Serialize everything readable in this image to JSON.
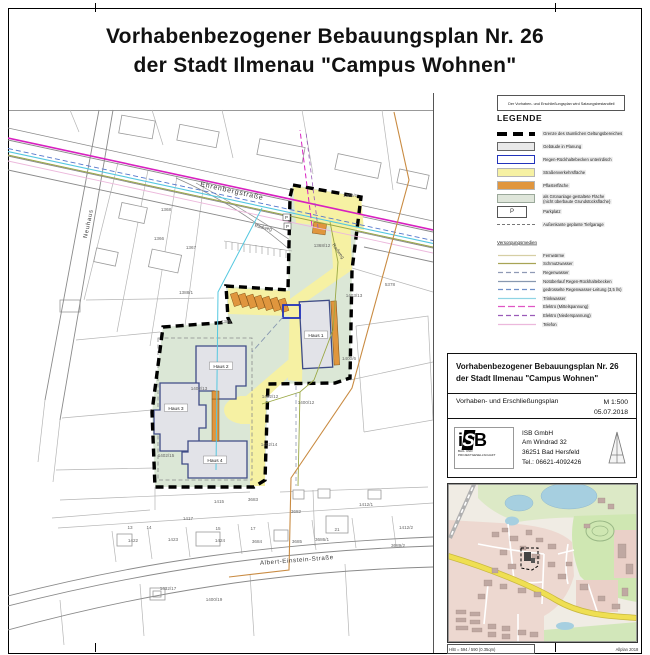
{
  "page": {
    "title_line1": "Vorhabenbezogener Bebauungsplan Nr. 26",
    "title_line2": "der Stadt Ilmenau \"Campus Wohnen\""
  },
  "legend": {
    "note": "Der Vorhaben- und Erschließungsplan wird Satzungsbestandteil",
    "heading": "LEGENDE",
    "parking_letter": "P",
    "areas": [
      {
        "type": "boundary",
        "label": "Grenze des räumlichen Geltungsbereiches"
      },
      {
        "type": "fill",
        "fill": "#e9e9e9",
        "stroke": "#666666",
        "label": "Gebäude in Planung"
      },
      {
        "type": "fill",
        "fill": "#ffffff",
        "stroke": "#2233bb",
        "bw": 1.6,
        "label": "Regen-Rückhaltebecken unterirdisch"
      },
      {
        "type": "fill",
        "fill": "#f6f1a3",
        "stroke": "#b5b5b5",
        "label": "Straßenverkehrsfläche"
      },
      {
        "type": "fill",
        "fill": "#e0963e",
        "stroke": "#b5b5b5",
        "label": "Pflasterfläche"
      },
      {
        "type": "fill",
        "fill": "#dfe6da",
        "stroke": "#9aa89a",
        "label": "als Grünanlage gestaltete Fläche",
        "label2": "(nicht überbaute Grundstücksfläche)"
      },
      {
        "type": "p",
        "label": "Parkplatz"
      },
      {
        "type": "dash",
        "label": "Außenkante geplante Tiefgarage"
      }
    ],
    "utilities_heading": "Versorgungsmedien",
    "utilities": [
      {
        "label": "Fernwärme",
        "color": "#d6cfa4",
        "dash": ""
      },
      {
        "label": "Schmutzwasser",
        "color": "#a8a455",
        "dash": ""
      },
      {
        "label": "Regenwasser",
        "color": "#8f9ab5",
        "dash": "5,3"
      },
      {
        "label": "Notüberlauf Regen-Rückhaltebecken",
        "color": "#8898b0",
        "dash": ""
      },
      {
        "label": "gedrosselte Regenwasser-Leitung (3,5 l/s)",
        "color": "#7090c8",
        "dash": "5,3"
      },
      {
        "label": "Trinkwasser",
        "color": "#8fd4e4",
        "dash": ""
      },
      {
        "label": "Elektro (Mittelspannung)",
        "color": "#e055c5",
        "dash": "7,3"
      },
      {
        "label": "Elektro (Niederspannung)",
        "color": "#9a5ab8",
        "dash": "5,3"
      },
      {
        "label": "Telefon",
        "color": "#ecb8dc",
        "dash": ""
      }
    ]
  },
  "titleblock": {
    "title_line1": "Vorhabenbezogener Bebauungsplan Nr. 26",
    "title_line2": "der Stadt Ilmenau \"Campus Wohnen\"",
    "subtitle": "Vorhaben- und Erschließungsplan",
    "scale": "M 1:500",
    "date": "05.07.2018",
    "company": {
      "name": "ISB GmbH",
      "street": "Am Windrad 32",
      "city": "36251  Bad Hersfeld",
      "phone": "Tel.: 06621-4092426"
    },
    "logo": {
      "i": "i",
      "s": "S",
      "b": "B",
      "sub1": "BAU- UND",
      "sub2": "PROJEKTGESELLSCHAFT"
    }
  },
  "minimap": {
    "caption_left": "H/B = 594 / 590 (0.35qm)",
    "caption_right": "Allplan 2018"
  },
  "map": {
    "colors": {
      "street_yellow": "#f6f1a3",
      "paving_orange": "#e0963e",
      "green_area": "#dbe7d6",
      "building_fill": "#e2e3e8",
      "building_stroke": "#3f4c86",
      "basin_stroke": "#2233bb",
      "boundary": "#000000",
      "elektro_ms": "#d820c0",
      "trinkwasser": "#55c8e0",
      "schmutzwasser": "#9aa845",
      "regenwasser": "#5577cc",
      "fernwaerme": "#c98b42"
    },
    "parking_letter": "P",
    "streets": [
      {
        "name": "Ehrenbergstraße",
        "x": 200,
        "y": 186,
        "rot": 12.5,
        "fs": 7,
        "ls": 0.8,
        "anchor": "start"
      },
      {
        "name": "Neuhaus",
        "x": 90,
        "y": 224,
        "rot": -78,
        "fs": 6,
        "ls": 0.8,
        "anchor": "middle"
      },
      {
        "name": "Albert-Einstein-Straße",
        "x": 297,
        "y": 562,
        "rot": -4.5,
        "fs": 6.2,
        "ls": 0.6,
        "anchor": "middle"
      }
    ],
    "path_labels": [
      {
        "t": "Radweg",
        "x": 263,
        "y": 229,
        "rot": 13
      },
      {
        "t": "Radweg",
        "x": 337,
        "y": 252,
        "rot": 55
      }
    ],
    "houses": [
      {
        "label": "Haus 1",
        "x": 316,
        "y": 336
      },
      {
        "label": "Haus 2",
        "x": 221,
        "y": 367
      },
      {
        "label": "Haus 3",
        "x": 176,
        "y": 409
      },
      {
        "label": "Haus 4",
        "x": 215,
        "y": 461
      }
    ],
    "parcel_labels": [
      {
        "t": "1368",
        "x": 166,
        "y": 211
      },
      {
        "t": "1366",
        "x": 159,
        "y": 240
      },
      {
        "t": "1367",
        "x": 191,
        "y": 249
      },
      {
        "t": "1388/1",
        "x": 186,
        "y": 294
      },
      {
        "t": "1386",
        "x": 226,
        "y": 323
      },
      {
        "t": "1368/6",
        "x": 350,
        "y": 197
      },
      {
        "t": "1368/12",
        "x": 322,
        "y": 247
      },
      {
        "t": "5378",
        "x": 390,
        "y": 286
      },
      {
        "t": "1403/13",
        "x": 354,
        "y": 297
      },
      {
        "t": "1400/6",
        "x": 349,
        "y": 360
      },
      {
        "t": "1400/12",
        "x": 306,
        "y": 404
      },
      {
        "t": "1402/12",
        "x": 270,
        "y": 398
      },
      {
        "t": "1402/13",
        "x": 199,
        "y": 390
      },
      {
        "t": "1402/14",
        "x": 269,
        "y": 446
      },
      {
        "t": "1402/15",
        "x": 166,
        "y": 457
      },
      {
        "t": "1415",
        "x": 219,
        "y": 503
      },
      {
        "t": "3683",
        "x": 253,
        "y": 501
      },
      {
        "t": "3682",
        "x": 296,
        "y": 513
      },
      {
        "t": "1412/1",
        "x": 366,
        "y": 506
      },
      {
        "t": "1412/2",
        "x": 406,
        "y": 529
      },
      {
        "t": "3689/2",
        "x": 398,
        "y": 547
      },
      {
        "t": "1417",
        "x": 188,
        "y": 520
      },
      {
        "t": "13",
        "x": 130,
        "y": 529
      },
      {
        "t": "14",
        "x": 149,
        "y": 529
      },
      {
        "t": "15",
        "x": 218,
        "y": 530
      },
      {
        "t": "17",
        "x": 253,
        "y": 530
      },
      {
        "t": "21",
        "x": 337,
        "y": 531
      },
      {
        "t": "1422",
        "x": 133,
        "y": 542
      },
      {
        "t": "1423",
        "x": 173,
        "y": 541
      },
      {
        "t": "1424",
        "x": 220,
        "y": 542
      },
      {
        "t": "3684",
        "x": 257,
        "y": 543
      },
      {
        "t": "3685",
        "x": 297,
        "y": 543
      },
      {
        "t": "3686/1",
        "x": 322,
        "y": 541
      },
      {
        "t": "1432/17",
        "x": 168,
        "y": 590
      },
      {
        "t": "1400/19",
        "x": 214,
        "y": 601
      }
    ],
    "parking": [
      {
        "x": 283,
        "y": 214
      },
      {
        "x": 284,
        "y": 223
      }
    ]
  }
}
